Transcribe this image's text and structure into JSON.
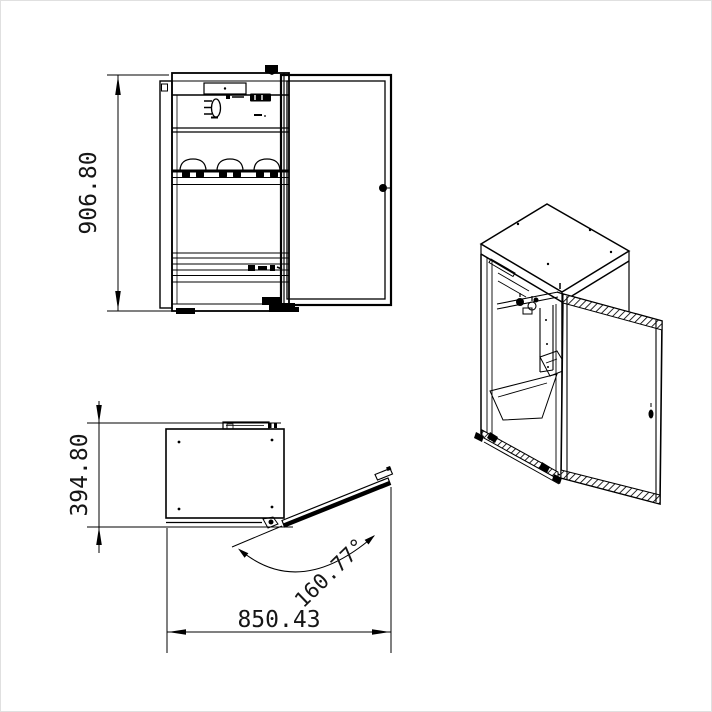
{
  "drawing": {
    "type": "cad-technical-drawing",
    "colors": {
      "line": "#000000",
      "background": "#ffffff"
    },
    "front_view": {
      "height_dim": "906.80"
    },
    "plan_view": {
      "depth_dim": "394.80",
      "width_dim": "850.43",
      "door_angle_dim": "160.77°"
    }
  }
}
